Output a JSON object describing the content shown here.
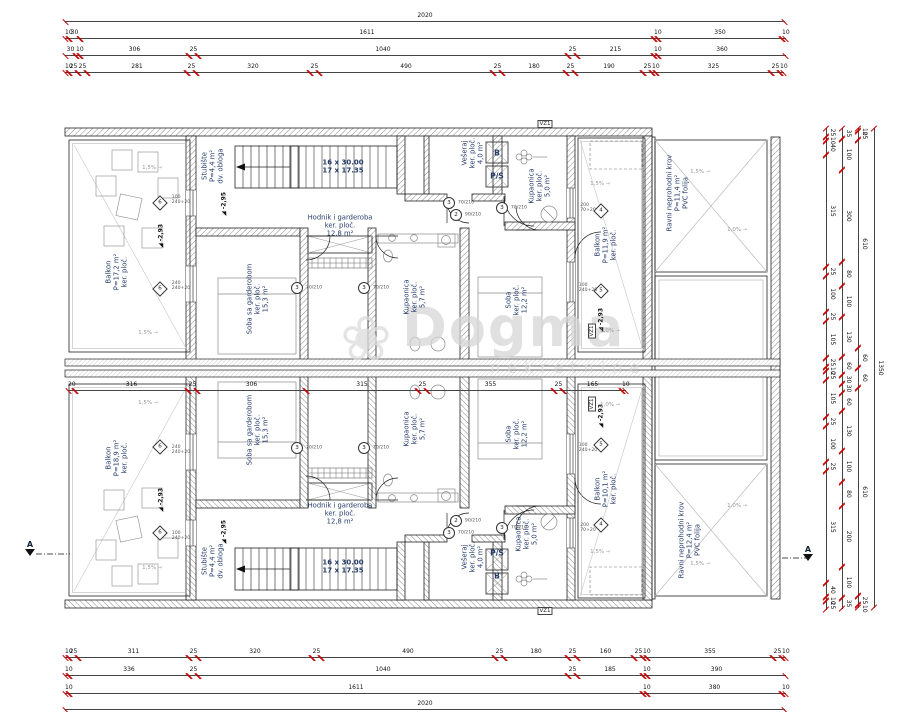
{
  "watermark": {
    "brand": "Dogma",
    "sub": "nekretnine",
    "icon": "flower-icon",
    "icon_glyph": "❀",
    "color": "#d6d6d6"
  },
  "plan": {
    "wall_color": "#222222",
    "tick_color": "#c70000",
    "label_color": "#263c6b",
    "total_width_cm": "2020",
    "total_height_cm": "1350"
  },
  "dims": {
    "top1": [
      {
        "x": 65,
        "w": 720,
        "t": "2020"
      }
    ],
    "top2": [
      {
        "x": 65,
        "w": 4,
        "t": "10"
      },
      {
        "x": 69,
        "w": 11,
        "t": "30"
      },
      {
        "x": 80,
        "w": 574,
        "t": "1611"
      },
      {
        "x": 654,
        "w": 4,
        "t": "10"
      },
      {
        "x": 658,
        "w": 124,
        "t": "350"
      },
      {
        "x": 782,
        "w": 4,
        "t": "10"
      }
    ],
    "top3": [
      {
        "x": 65,
        "w": 11,
        "t": "30"
      },
      {
        "x": 76,
        "w": 4,
        "t": "10"
      },
      {
        "x": 80,
        "w": 109,
        "t": "306"
      },
      {
        "x": 189,
        "w": 9,
        "t": "25"
      },
      {
        "x": 198,
        "w": 370,
        "t": "1040"
      },
      {
        "x": 568,
        "w": 9,
        "t": "25"
      },
      {
        "x": 577,
        "w": 77,
        "t": "215"
      },
      {
        "x": 654,
        "w": 4,
        "t": "10"
      },
      {
        "x": 658,
        "w": 128,
        "t": "360"
      }
    ],
    "top4": [
      {
        "x": 65,
        "w": 4,
        "t": "10"
      },
      {
        "x": 69,
        "w": 9,
        "t": "25"
      },
      {
        "x": 78,
        "w": 9,
        "t": "25"
      },
      {
        "x": 87,
        "w": 100,
        "t": "281"
      },
      {
        "x": 187,
        "w": 9,
        "t": "25"
      },
      {
        "x": 196,
        "w": 114,
        "t": "320"
      },
      {
        "x": 310,
        "w": 9,
        "t": "25"
      },
      {
        "x": 319,
        "w": 174,
        "t": "490"
      },
      {
        "x": 493,
        "w": 9,
        "t": "25"
      },
      {
        "x": 502,
        "w": 64,
        "t": "180"
      },
      {
        "x": 566,
        "w": 9,
        "t": "25"
      },
      {
        "x": 575,
        "w": 68,
        "t": "190"
      },
      {
        "x": 643,
        "w": 9,
        "t": "25"
      },
      {
        "x": 652,
        "w": 4,
        "t": "10"
      },
      {
        "x": 656,
        "w": 115,
        "t": "325"
      },
      {
        "x": 771,
        "w": 9,
        "t": "25"
      },
      {
        "x": 780,
        "w": 4,
        "t": "10"
      }
    ],
    "mid": [
      {
        "x": 68,
        "w": 7,
        "t": "20"
      },
      {
        "x": 75,
        "w": 113,
        "t": "316"
      },
      {
        "x": 188,
        "w": 9,
        "t": "25"
      },
      {
        "x": 197,
        "w": 109,
        "t": "306"
      },
      {
        "x": 306,
        "w": 112,
        "t": "315"
      },
      {
        "x": 418,
        "w": 9,
        "t": "25"
      },
      {
        "x": 427,
        "w": 127,
        "t": "355"
      },
      {
        "x": 554,
        "w": 9,
        "t": "25"
      },
      {
        "x": 563,
        "w": 59,
        "t": "165"
      },
      {
        "x": 622,
        "w": 4,
        "t": "10"
      }
    ],
    "bot1": [
      {
        "x": 65,
        "w": 4,
        "t": "10"
      },
      {
        "x": 69,
        "w": 9,
        "t": "25"
      },
      {
        "x": 78,
        "w": 111,
        "t": "311"
      },
      {
        "x": 189,
        "w": 9,
        "t": "25"
      },
      {
        "x": 198,
        "w": 114,
        "t": "320"
      },
      {
        "x": 312,
        "w": 9,
        "t": "25"
      },
      {
        "x": 321,
        "w": 174,
        "t": "490"
      },
      {
        "x": 495,
        "w": 9,
        "t": "25"
      },
      {
        "x": 504,
        "w": 64,
        "t": "180"
      },
      {
        "x": 568,
        "w": 9,
        "t": "25"
      },
      {
        "x": 577,
        "w": 57,
        "t": "160"
      },
      {
        "x": 634,
        "w": 9,
        "t": "25"
      },
      {
        "x": 643,
        "w": 4,
        "t": "10"
      },
      {
        "x": 647,
        "w": 126,
        "t": "355"
      },
      {
        "x": 773,
        "w": 9,
        "t": "25"
      },
      {
        "x": 782,
        "w": 4,
        "t": "10"
      }
    ],
    "bot2": [
      {
        "x": 65,
        "w": 4,
        "t": "10"
      },
      {
        "x": 69,
        "w": 120,
        "t": "336"
      },
      {
        "x": 189,
        "w": 9,
        "t": "25"
      },
      {
        "x": 198,
        "w": 370,
        "t": "1040"
      },
      {
        "x": 568,
        "w": 9,
        "t": "25"
      },
      {
        "x": 577,
        "w": 66,
        "t": "185"
      },
      {
        "x": 643,
        "w": 4,
        "t": "10"
      },
      {
        "x": 647,
        "w": 139,
        "t": "390"
      }
    ],
    "bot3": [
      {
        "x": 65,
        "w": 4,
        "t": "10"
      },
      {
        "x": 69,
        "w": 574,
        "t": "1611"
      },
      {
        "x": 643,
        "w": 4,
        "t": "10"
      },
      {
        "x": 647,
        "w": 135,
        "t": "380"
      },
      {
        "x": 782,
        "w": 4,
        "t": "10"
      }
    ],
    "bot4": [
      {
        "x": 65,
        "w": 720,
        "t": "2020"
      }
    ],
    "v1": [
      {
        "x": 0,
        "w": 9,
        "t": "25"
      },
      {
        "x": 9,
        "w": 4,
        "t": "10"
      },
      {
        "x": 13,
        "w": 14,
        "t": "40"
      },
      {
        "x": 27,
        "w": 112,
        "t": "315"
      },
      {
        "x": 139,
        "w": 9,
        "t": "25"
      },
      {
        "x": 148,
        "w": 36,
        "t": "100"
      },
      {
        "x": 184,
        "w": 9,
        "t": "25"
      },
      {
        "x": 193,
        "w": 37,
        "t": "105"
      },
      {
        "x": 230,
        "w": 9,
        "t": "25"
      },
      {
        "x": 239,
        "w": 4,
        "t": "10"
      },
      {
        "x": 243,
        "w": 9,
        "t": "25"
      },
      {
        "x": 252,
        "w": 37,
        "t": "105"
      },
      {
        "x": 289,
        "w": 9,
        "t": "25"
      },
      {
        "x": 298,
        "w": 36,
        "t": "100"
      },
      {
        "x": 334,
        "w": 9,
        "t": "25"
      },
      {
        "x": 343,
        "w": 112,
        "t": "315"
      },
      {
        "x": 455,
        "w": 14,
        "t": "40"
      },
      {
        "x": 469,
        "w": 4,
        "t": "10"
      },
      {
        "x": 473,
        "w": 9,
        "t": "25"
      }
    ],
    "v2": [
      {
        "x": 0,
        "w": 11,
        "t": "35"
      },
      {
        "x": 11,
        "w": 31,
        "t": "100"
      },
      {
        "x": 42,
        "w": 92,
        "t": "300"
      },
      {
        "x": 134,
        "w": 24,
        "t": "80"
      },
      {
        "x": 158,
        "w": 31,
        "t": "100"
      },
      {
        "x": 189,
        "w": 40,
        "t": "130"
      },
      {
        "x": 229,
        "w": 18,
        "t": "60"
      },
      {
        "x": 247,
        "w": 9,
        "t": "30"
      },
      {
        "x": 256,
        "w": 9,
        "t": "30"
      },
      {
        "x": 265,
        "w": 18,
        "t": "60"
      },
      {
        "x": 283,
        "w": 40,
        "t": "130"
      },
      {
        "x": 323,
        "w": 31,
        "t": "100"
      },
      {
        "x": 354,
        "w": 24,
        "t": "80"
      },
      {
        "x": 378,
        "w": 61,
        "t": "200"
      },
      {
        "x": 439,
        "w": 31,
        "t": "100"
      },
      {
        "x": 470,
        "w": 11,
        "t": "35"
      }
    ],
    "v3": [
      {
        "x": 0,
        "w": 3,
        "t": "10"
      },
      {
        "x": 3,
        "w": 9,
        "t": "25"
      },
      {
        "x": 12,
        "w": 208,
        "t": "610"
      },
      {
        "x": 220,
        "w": 20,
        "t": "60"
      },
      {
        "x": 240,
        "w": 20,
        "t": "60"
      },
      {
        "x": 260,
        "w": 208,
        "t": "610"
      },
      {
        "x": 468,
        "w": 9,
        "t": "25"
      },
      {
        "x": 477,
        "w": 3,
        "t": "10"
      }
    ],
    "v4": [
      {
        "x": 0,
        "w": 480,
        "t": "1350"
      }
    ]
  },
  "labels": {
    "rooms": [
      {
        "x": 117,
        "y": 272,
        "r": -90,
        "t": "Balkon\nP=17,2 m²\nker. ploč."
      },
      {
        "x": 213,
        "y": 166,
        "r": -90,
        "t": "Stubište\nP=4,4 m²\ndv. obloga"
      },
      {
        "x": 340,
        "y": 226,
        "r": 0,
        "t": "Hodnik i garderoba\nker. ploč.\n12,8 m²"
      },
      {
        "x": 258,
        "y": 299,
        "r": -90,
        "t": "Soba sa garderobom\nker. ploč.\n15,3 m²"
      },
      {
        "x": 415,
        "y": 297,
        "r": -90,
        "t": "Kupaonica\nker. ploč.\n5,7 m²"
      },
      {
        "x": 473,
        "y": 153,
        "r": -90,
        "t": "Vešeraj\nker. ploč.\n4,0 m²"
      },
      {
        "x": 540,
        "y": 186,
        "r": -90,
        "t": "Kupaonica\nker. ploč.\n5,0 m²"
      },
      {
        "x": 517,
        "y": 300,
        "r": -90,
        "t": "Soba\nker. ploč.\n12,2 m²"
      },
      {
        "x": 606,
        "y": 245,
        "r": -90,
        "t": "Balkon\nP=11,9 m²\nker. ploč."
      },
      {
        "x": 678,
        "y": 193,
        "r": -90,
        "t": "Ravni neprohodni krov\nP=11,4 m²\nPVC folija"
      },
      {
        "x": 117,
        "y": 458,
        "r": -90,
        "t": "Balkon\nP=18,9 m²\nker. ploč."
      },
      {
        "x": 213,
        "y": 561,
        "r": -90,
        "t": "Stubište\nP=4,4 m²\ndv. obloga"
      },
      {
        "x": 340,
        "y": 514,
        "r": 0,
        "t": "Hodnik i garderoba\nker. ploč.\n12,8 m²"
      },
      {
        "x": 258,
        "y": 430,
        "r": -90,
        "t": "Soba sa garderobom\nker. ploč.\n15,3 m²"
      },
      {
        "x": 415,
        "y": 429,
        "r": -90,
        "t": "Kupaonica\nker. ploč.\n5,7 m²"
      },
      {
        "x": 473,
        "y": 557,
        "r": -90,
        "t": "Vešeraj\nker. ploč.\n4,0 m²"
      },
      {
        "x": 527,
        "y": 534,
        "r": -90,
        "t": "Kupaonica\nker. ploč.\n5,0 m²"
      },
      {
        "x": 517,
        "y": 434,
        "r": -90,
        "t": "Soba\nker. ploč.\n12,2 m²"
      },
      {
        "x": 606,
        "y": 489,
        "r": -90,
        "t": "Balkon\nP=10,1 m²\nker. ploč."
      },
      {
        "x": 690,
        "y": 540,
        "r": -90,
        "t": "Ravni neprohodni krov\nP=12,4 m²\nPVC folija"
      }
    ],
    "stairs": [
      {
        "x": 343,
        "y": 167,
        "r": 0,
        "t": "16 x 30.00\n17 x 17.35"
      },
      {
        "x": 343,
        "y": 567,
        "r": 0,
        "t": "16 x 30.00\n17 x 17.35"
      }
    ],
    "apps": [
      {
        "x": 497,
        "y": 153,
        "r": 0,
        "t": "B"
      },
      {
        "x": 497,
        "y": 176,
        "r": 0,
        "t": "P/S"
      },
      {
        "x": 497,
        "y": 553,
        "r": 0,
        "t": "P/S"
      },
      {
        "x": 497,
        "y": 576,
        "r": 0,
        "t": "B"
      }
    ],
    "vz": [
      {
        "x": 592,
        "y": 331,
        "r": -90,
        "t": "VZ1"
      },
      {
        "x": 592,
        "y": 404,
        "r": -90,
        "t": "VZ1"
      },
      {
        "x": 545,
        "y": 124,
        "r": 0,
        "t": "VZ1"
      },
      {
        "x": 545,
        "y": 611,
        "r": 0,
        "t": "VZ1"
      }
    ],
    "levels": [
      {
        "x": 224,
        "y": 204,
        "r": -90,
        "t": "-2,95"
      },
      {
        "x": 161,
        "y": 236,
        "r": -90,
        "t": "-2,93"
      },
      {
        "x": 601,
        "y": 320,
        "r": -90,
        "t": "-2,93"
      },
      {
        "x": 224,
        "y": 532,
        "r": -90,
        "t": "-2,95"
      },
      {
        "x": 161,
        "y": 500,
        "r": -90,
        "t": "-2,93"
      },
      {
        "x": 601,
        "y": 416,
        "r": -90,
        "t": "-2,93"
      }
    ],
    "slopes": [
      {
        "x": 152,
        "y": 168,
        "r": 0,
        "t": "1,5%"
      },
      {
        "x": 148,
        "y": 333,
        "r": 0,
        "t": "1,5%"
      },
      {
        "x": 600,
        "y": 184,
        "r": 0,
        "t": "1,5%"
      },
      {
        "x": 610,
        "y": 331,
        "r": 0,
        "t": "1,0%"
      },
      {
        "x": 700,
        "y": 172,
        "r": 0,
        "t": "1,5%"
      },
      {
        "x": 737,
        "y": 230,
        "r": 0,
        "t": "1,0%"
      },
      {
        "x": 152,
        "y": 568,
        "r": 0,
        "t": "1,5%"
      },
      {
        "x": 148,
        "y": 403,
        "r": 0,
        "t": "1,5%"
      },
      {
        "x": 600,
        "y": 552,
        "r": 0,
        "t": "1,5%"
      },
      {
        "x": 610,
        "y": 405,
        "r": 0,
        "t": "1,0%"
      },
      {
        "x": 700,
        "y": 564,
        "r": 0,
        "t": "1,5%"
      },
      {
        "x": 737,
        "y": 506,
        "r": 0,
        "t": "1,0%"
      }
    ],
    "circles": [
      {
        "x": 449,
        "y": 203,
        "r": 0,
        "t": "3"
      },
      {
        "x": 456,
        "y": 215,
        "r": 0,
        "t": "2"
      },
      {
        "x": 502,
        "y": 208,
        "r": 0,
        "t": "3"
      },
      {
        "x": 297,
        "y": 288,
        "r": 0,
        "t": "3"
      },
      {
        "x": 364,
        "y": 288,
        "r": 0,
        "t": "3"
      },
      {
        "x": 449,
        "y": 533,
        "r": 0,
        "t": "3"
      },
      {
        "x": 456,
        "y": 521,
        "r": 0,
        "t": "2"
      },
      {
        "x": 502,
        "y": 528,
        "r": 0,
        "t": "3"
      },
      {
        "x": 297,
        "y": 448,
        "r": 0,
        "t": "3"
      },
      {
        "x": 364,
        "y": 448,
        "r": 0,
        "t": "3"
      }
    ],
    "circle_notes": [
      {
        "x": 466,
        "y": 203,
        "r": 0,
        "t": "70/210"
      },
      {
        "x": 473,
        "y": 215,
        "r": 0,
        "t": "90/210"
      },
      {
        "x": 519,
        "y": 208,
        "r": 0,
        "t": "70/210"
      },
      {
        "x": 314,
        "y": 288,
        "r": 0,
        "t": "70/210"
      },
      {
        "x": 381,
        "y": 288,
        "r": 0,
        "t": "70/210"
      },
      {
        "x": 466,
        "y": 533,
        "r": 0,
        "t": "70/210"
      },
      {
        "x": 473,
        "y": 521,
        "r": 0,
        "t": "90/210"
      },
      {
        "x": 519,
        "y": 528,
        "r": 0,
        "t": "70/210"
      },
      {
        "x": 314,
        "y": 448,
        "r": 0,
        "t": "70/210"
      },
      {
        "x": 381,
        "y": 448,
        "r": 0,
        "t": "70/210"
      }
    ],
    "diamonds": [
      {
        "x": 160,
        "y": 203,
        "r": 0,
        "t": "6"
      },
      {
        "x": 160,
        "y": 289,
        "r": 0,
        "t": "6"
      },
      {
        "x": 601,
        "y": 211,
        "r": 0,
        "t": "4"
      },
      {
        "x": 601,
        "y": 291,
        "r": 0,
        "t": "5"
      },
      {
        "x": 160,
        "y": 533,
        "r": 0,
        "t": "6"
      },
      {
        "x": 160,
        "y": 447,
        "r": 0,
        "t": "6"
      },
      {
        "x": 601,
        "y": 525,
        "r": 0,
        "t": "4"
      },
      {
        "x": 601,
        "y": 445,
        "r": 0,
        "t": "5"
      }
    ],
    "diamond_notes": [
      {
        "x": 181,
        "y": 200,
        "r": 0,
        "t": "100\n240+20"
      },
      {
        "x": 181,
        "y": 286,
        "r": 0,
        "t": "240\n240+20"
      },
      {
        "x": 588,
        "y": 208,
        "r": 0,
        "t": "200\n70+20"
      },
      {
        "x": 588,
        "y": 288,
        "r": 0,
        "t": "100\n240+20"
      },
      {
        "x": 181,
        "y": 536,
        "r": 0,
        "t": "100\n240+20"
      },
      {
        "x": 181,
        "y": 450,
        "r": 0,
        "t": "240\n240+20"
      },
      {
        "x": 588,
        "y": 528,
        "r": 0,
        "t": "200\n70+20"
      },
      {
        "x": 588,
        "y": 448,
        "r": 0,
        "t": "100\n240+20"
      }
    ],
    "sections": [
      {
        "x": 30,
        "y": 548,
        "r": 0,
        "t": "A"
      },
      {
        "x": 808,
        "y": 553,
        "r": 0,
        "t": "A"
      }
    ]
  }
}
